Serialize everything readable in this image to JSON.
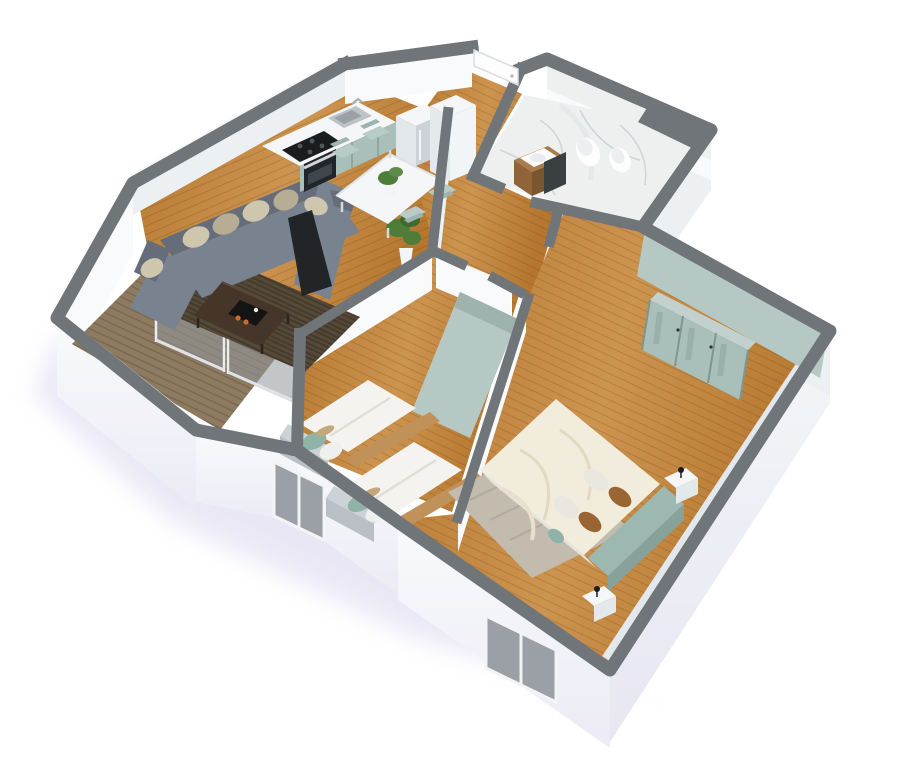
{
  "scene": {
    "type": "3d-isometric-apartment-floor-plan",
    "rooms": [
      "living-room",
      "kitchen",
      "dining-area",
      "hallway",
      "bathroom",
      "kids-bedroom",
      "master-bedroom",
      "balcony"
    ],
    "objects": [
      "sofa",
      "coffee-table",
      "living-rug",
      "kitchen-counter",
      "cooktop",
      "oven",
      "sink",
      "fridge",
      "tall-cabinet",
      "dining-table",
      "dining-chairs",
      "table-plant",
      "floor-plant",
      "toilet",
      "bidet",
      "vanity",
      "mirror",
      "kids-bed-1",
      "kids-bed-2",
      "kids-wardrobe",
      "master-bed",
      "headboard",
      "master-rug",
      "nightstand-1",
      "nightstand-2",
      "master-wardrobe",
      "glass-sliding-door",
      "entry-door",
      "kids-window",
      "master-window",
      "balcony-floor"
    ]
  },
  "colors": {
    "wall_top": "#70757a",
    "wall_top_light": "#7b8085",
    "wall_white": "#f8fafb",
    "wall_shade": "#edf0f3",
    "wall_shade2": "#e2e7ec",
    "shadow_lavender": "#d5d1ec",
    "wood_light": "#cd9450",
    "wood_mid": "#b5772f",
    "wood_dark": "#9a6023",
    "balcony_wood": "#8d7a60",
    "marble": "#eef0f0",
    "marble_vein": "#c4c9cc",
    "accent_teal": "#b6c8c4",
    "accent_teal_dark": "#93aaa6",
    "cabinet_sage": "#a8bfba",
    "chair_sage": "#b7cbc7",
    "sofa": "#798390",
    "sofa_dark": "#646d79",
    "pillow_beige": "#cfc6ae",
    "pillow_beige2": "#b7ac94",
    "rug_brown": "#55493a",
    "coffee_table": "#453629",
    "appliance_black": "#1a1d1f",
    "steel": "#bcc3c8",
    "bed_white": "#f4f3ef",
    "bed_frame_wood": "#c09259",
    "pillow_teal": "#8fb3a7",
    "pillow_tan": "#c4a77b",
    "master_duvet": "#f2ecdc",
    "headboard_teal": "#9db8b1",
    "pillow_brown": "#996633",
    "master_rug": "#c3bcae",
    "glass": "#8f979d",
    "plant_green": "#4e7d3a",
    "mirror_dark": "#3a3f42",
    "vanity_wood": "#a97c4a"
  }
}
